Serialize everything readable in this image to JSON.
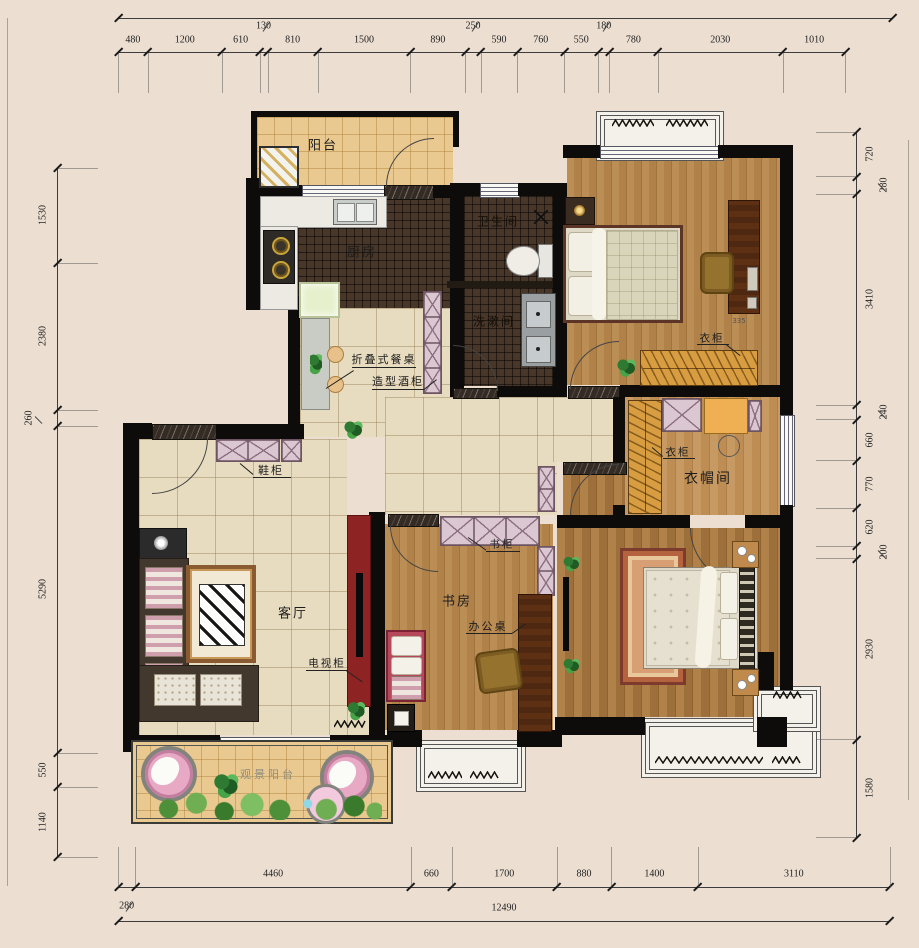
{
  "meta": {
    "drawing_type": "residential floor plan"
  },
  "palette": {
    "background": "#ecdfd2",
    "wall": "#0d0c0a",
    "balcony_tile": "#e9c98f",
    "dark_tile": "#483728",
    "beige_tile": "#e8dcc0",
    "wood_floor": "#b3834c",
    "cabinet_pink": "#dbc7d1",
    "wardrobe_orange": "#d89d41",
    "tv_wall_red": "#8e2323",
    "accent_green": "#2f7a33",
    "chair_pink": "#e8a9c4"
  },
  "rooms": {
    "balcony_top": "阳台",
    "kitchen": "厨房",
    "bathroom": "卫生间",
    "washroom": "洗漱间",
    "cloakroom": "衣帽间",
    "living_room": "客厅",
    "study": "书房",
    "balcony_bottom": "观景阳台"
  },
  "furniture_labels": {
    "folding_table": "折叠式餐桌",
    "wine_cabinet": "造型酒柜",
    "shoe_cabinet": "鞋柜",
    "wardrobe_bedroom": "衣柜",
    "wardrobe_dim": "335",
    "wardrobe_cloakroom": "衣柜",
    "bookcase": "书柜",
    "office_desk": "办公桌",
    "tv_cabinet": "电视柜"
  },
  "dimensions": {
    "top": [
      {
        "v": 480
      },
      {
        "v": 1200
      },
      {
        "v": 610
      },
      {
        "v": 130,
        "small": true
      },
      {
        "v": 810
      },
      {
        "v": 1500
      },
      {
        "v": 890
      },
      {
        "v": 250,
        "small": true
      },
      {
        "v": 590
      },
      {
        "v": 760
      },
      {
        "v": 550
      },
      {
        "v": 180,
        "small": true
      },
      {
        "v": 780
      },
      {
        "v": 2030
      },
      {
        "v": 1010
      }
    ],
    "left": [
      {
        "v": 1530
      },
      {
        "v": 2380
      },
      {
        "v": 260,
        "small": true
      },
      {
        "v": 5290
      },
      {
        "v": 550
      },
      {
        "v": 1140
      }
    ],
    "right": [
      {
        "v": 720
      },
      {
        "v": 280,
        "small": true
      },
      {
        "v": 3410
      },
      {
        "v": 240,
        "small": true
      },
      {
        "v": 660
      },
      {
        "v": 770
      },
      {
        "v": 620
      },
      {
        "v": 200,
        "small": true
      },
      {
        "v": 2930
      },
      {
        "v": 1580
      }
    ],
    "bottom": [
      {
        "v": 280,
        "small": true
      },
      {
        "v": 4460
      },
      {
        "v": 660
      },
      {
        "v": 1700
      },
      {
        "v": 880
      },
      {
        "v": 1400
      },
      {
        "v": 3110
      }
    ],
    "bottom_total": [
      {
        "v": 12490
      }
    ]
  }
}
